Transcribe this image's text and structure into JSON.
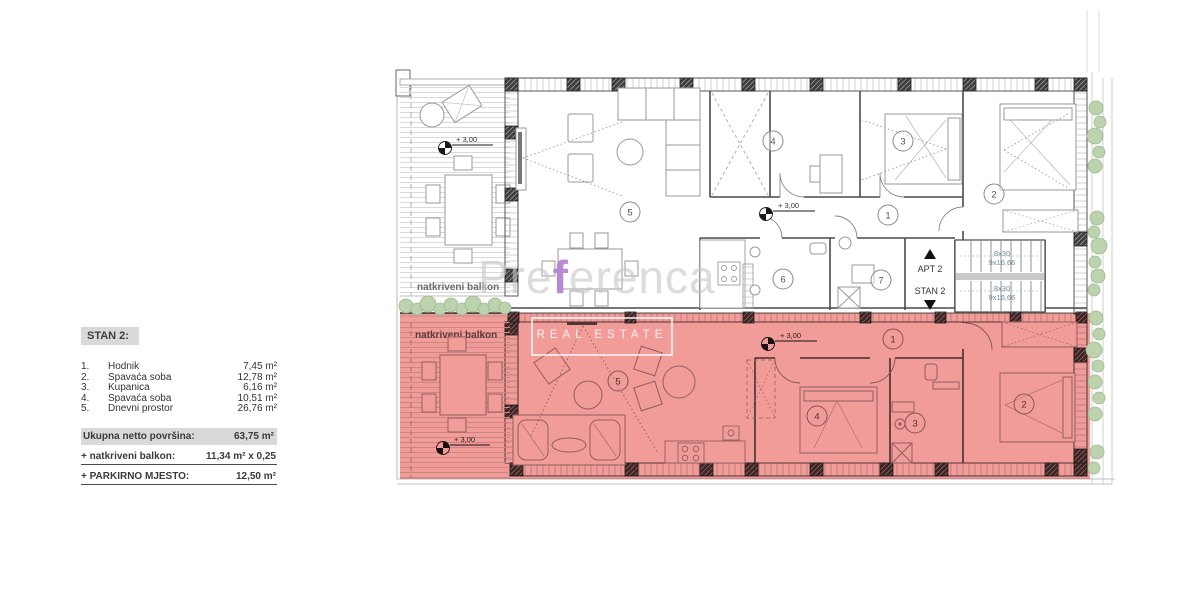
{
  "legend": {
    "title": "STAN 2:",
    "rooms": [
      {
        "num": "1.",
        "name": "Hodnik",
        "area": "7,45 m²"
      },
      {
        "num": "2.",
        "name": "Spavaća soba",
        "area": "12,78 m²"
      },
      {
        "num": "3.",
        "name": "Kupanica",
        "area": "6,16 m²"
      },
      {
        "num": "4.",
        "name": "Spavaća soba",
        "area": "10,51 m²"
      },
      {
        "num": "5.",
        "name": "Dnevni prostor",
        "area": "26,76 m²"
      }
    ],
    "total_label": "Ukupna netto površina:",
    "total_value": "63,75 m²",
    "balcony_label": "+ natkriveni balkon:",
    "balcony_value": "11,34 m² x 0,25",
    "parking_label": "+ PARKIRNO MJESTO:",
    "parking_value": "12,50 m²"
  },
  "plan": {
    "balcony_label": "natkriveni balkon",
    "elevation_label": "+ 3,00",
    "stairs": {
      "up_label": "APT 2",
      "down_label": "STAN 2",
      "flights": [
        {
          "steps": "8x30",
          "riser": "9x16,66"
        },
        {
          "steps": "8x30",
          "riser": "9x16,66"
        }
      ]
    },
    "upper_room_numbers": [
      "5",
      "4",
      "3",
      "1",
      "2",
      "6",
      "7"
    ],
    "stan2_room_numbers": [
      "5",
      "1",
      "4",
      "3",
      "2"
    ]
  },
  "watermark": {
    "brand_pre": "Pre",
    "brand_f": "f",
    "brand_rest": "erenca",
    "subtitle": "REAL ESTATE"
  },
  "colors": {
    "highlight_red": "#ee837f",
    "legend_gray": "#d9d9d9",
    "vegetation_green": "#bcd3ae",
    "watermark_purple": "#b27ecd",
    "stairs_text": "#6b8b99"
  }
}
